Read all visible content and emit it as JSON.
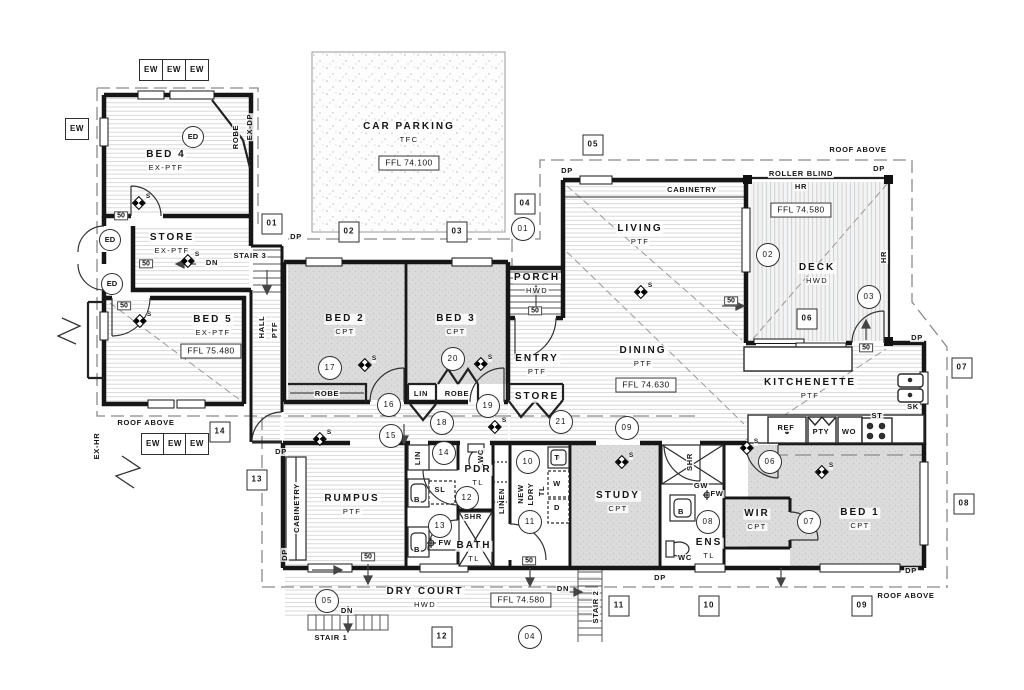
{
  "drawing_title": "Ground Floor Plan",
  "rooms": [
    {
      "nm": "bed-4",
      "l1": "BED 4",
      "l2": "EX-PTF",
      "x": 166,
      "y": 155
    },
    {
      "nm": "store-existing",
      "l1": "STORE",
      "l2": "EX-PTF",
      "x": 172,
      "y": 238
    },
    {
      "nm": "bed-5",
      "l1": "BED 5",
      "l2": "EX-PTF",
      "x": 213,
      "y": 320
    },
    {
      "nm": "car-parking",
      "l1": "CAR PARKING",
      "l2": "TFC",
      "x": 409,
      "y": 127
    },
    {
      "nm": "living",
      "l1": "LIVING",
      "l2": "PTF",
      "x": 640,
      "y": 229
    },
    {
      "nm": "deck",
      "l1": "DECK",
      "l2": "HWD",
      "x": 817,
      "y": 268
    },
    {
      "nm": "bed-2",
      "l1": "BED 2",
      "l2": "CPT",
      "x": 345,
      "y": 319
    },
    {
      "nm": "bed-3",
      "l1": "BED 3",
      "l2": "CPT",
      "x": 456,
      "y": 319
    },
    {
      "nm": "porch",
      "l1": "PORCH",
      "l2": "HWD",
      "x": 537,
      "y": 278
    },
    {
      "nm": "entry",
      "l1": "ENTRY",
      "l2": "PTF",
      "x": 537,
      "y": 359
    },
    {
      "nm": "entry-store",
      "l1": "STORE",
      "l2": "",
      "x": 537,
      "y": 397
    },
    {
      "nm": "dining",
      "l1": "DINING",
      "l2": "PTF",
      "x": 643,
      "y": 351
    },
    {
      "nm": "kitchenette",
      "l1": "KITCHENETTE",
      "l2": "PTF",
      "x": 810,
      "y": 383
    },
    {
      "nm": "rumpus",
      "l1": "RUMPUS",
      "l2": "PTF",
      "x": 352,
      "y": 499
    },
    {
      "nm": "pdr",
      "l1": "PDR",
      "l2": "TL",
      "x": 478,
      "y": 470
    },
    {
      "nm": "bath",
      "l1": "BATH",
      "l2": "TL",
      "x": 474,
      "y": 546
    },
    {
      "nm": "study",
      "l1": "STUDY",
      "l2": "CPT",
      "x": 618,
      "y": 496
    },
    {
      "nm": "wir",
      "l1": "WIR",
      "l2": "CPT",
      "x": 757,
      "y": 514
    },
    {
      "nm": "bed-1",
      "l1": "BED 1",
      "l2": "CPT",
      "x": 860,
      "y": 513
    },
    {
      "nm": "ens",
      "l1": "ENS",
      "l2": "TL",
      "x": 709,
      "y": 543
    },
    {
      "nm": "dry-court",
      "l1": "DRY COURT",
      "l2": "HWD",
      "x": 425,
      "y": 592
    }
  ],
  "ffl": [
    {
      "t": "FFL 74.100",
      "x": 409,
      "y": 163
    },
    {
      "t": "FFL 74.580",
      "x": 801,
      "y": 210
    },
    {
      "t": "FFL 75.480",
      "x": 211,
      "y": 351
    },
    {
      "t": "FFL 74.630",
      "x": 646,
      "y": 385
    },
    {
      "t": "FFL 74.580",
      "x": 521,
      "y": 600
    }
  ],
  "markers": {
    "circles": [
      {
        "n": "01",
        "x": 523,
        "y": 229
      },
      {
        "n": "02",
        "x": 768,
        "y": 255
      },
      {
        "n": "03",
        "x": 869,
        "y": 297
      },
      {
        "n": "04",
        "x": 530,
        "y": 637
      },
      {
        "n": "05",
        "x": 327,
        "y": 601
      },
      {
        "n": "06",
        "x": 770,
        "y": 462
      },
      {
        "n": "07",
        "x": 809,
        "y": 522
      },
      {
        "n": "08",
        "x": 708,
        "y": 522
      },
      {
        "n": "09",
        "x": 627,
        "y": 428
      },
      {
        "n": "10",
        "x": 528,
        "y": 462
      },
      {
        "n": "11",
        "x": 530,
        "y": 522
      },
      {
        "n": "12",
        "x": 467,
        "y": 498
      },
      {
        "n": "13",
        "x": 440,
        "y": 526
      },
      {
        "n": "14",
        "x": 444,
        "y": 453
      },
      {
        "n": "15",
        "x": 391,
        "y": 436
      },
      {
        "n": "16",
        "x": 389,
        "y": 405
      },
      {
        "n": "17",
        "x": 330,
        "y": 368
      },
      {
        "n": "18",
        "x": 442,
        "y": 423
      },
      {
        "n": "19",
        "x": 488,
        "y": 406
      },
      {
        "n": "20",
        "x": 453,
        "y": 359
      },
      {
        "n": "21",
        "x": 561,
        "y": 422
      }
    ],
    "squares": [
      {
        "n": "01",
        "x": 272,
        "y": 224
      },
      {
        "n": "02",
        "x": 349,
        "y": 232
      },
      {
        "n": "03",
        "x": 457,
        "y": 232
      },
      {
        "n": "04",
        "x": 525,
        "y": 204
      },
      {
        "n": "05",
        "x": 593,
        "y": 145
      },
      {
        "n": "06",
        "x": 807,
        "y": 319
      },
      {
        "n": "07",
        "x": 962,
        "y": 368
      },
      {
        "n": "08",
        "x": 964,
        "y": 504
      },
      {
        "n": "09",
        "x": 862,
        "y": 606
      },
      {
        "n": "10",
        "x": 709,
        "y": 606
      },
      {
        "n": "11",
        "x": 619,
        "y": 606
      },
      {
        "n": "12",
        "x": 442,
        "y": 637
      },
      {
        "n": "13",
        "x": 257,
        "y": 480
      },
      {
        "n": "14",
        "x": 220,
        "y": 432
      }
    ]
  },
  "ew": [
    {
      "t": "EW",
      "x": 151,
      "y": 70
    },
    {
      "t": "EW",
      "x": 174,
      "y": 70
    },
    {
      "t": "EW",
      "x": 197,
      "y": 70
    },
    {
      "t": "EW",
      "x": 77,
      "y": 129
    },
    {
      "t": "EW",
      "x": 153,
      "y": 444
    },
    {
      "t": "EW",
      "x": 175,
      "y": 444
    },
    {
      "t": "EW",
      "x": 197,
      "y": 444
    }
  ],
  "ed": [
    {
      "t": "ED",
      "x": 193,
      "y": 137
    },
    {
      "t": "ED",
      "x": 110,
      "y": 240
    },
    {
      "t": "ED",
      "x": 112,
      "y": 284
    }
  ],
  "fifty": [
    {
      "t": "50",
      "x": 121,
      "y": 216
    },
    {
      "t": "50",
      "x": 146,
      "y": 264
    },
    {
      "t": "50",
      "x": 124,
      "y": 306
    },
    {
      "t": "50",
      "x": 535,
      "y": 311
    },
    {
      "t": "50",
      "x": 731,
      "y": 301
    },
    {
      "t": "50",
      "x": 866,
      "y": 348
    },
    {
      "t": "50",
      "x": 368,
      "y": 557
    },
    {
      "t": "50",
      "x": 529,
      "y": 561
    }
  ],
  "notes": [
    {
      "t": "ROOF ABOVE",
      "x": 858,
      "y": 150
    },
    {
      "t": "ROOF ABOVE",
      "x": 146,
      "y": 423
    },
    {
      "t": "ROOF ABOVE",
      "x": 906,
      "y": 596
    },
    {
      "t": "ROLLER BLIND",
      "x": 801,
      "y": 174
    },
    {
      "t": "HR",
      "x": 801,
      "y": 187
    },
    {
      "t": "HR",
      "x": 884,
      "y": 257,
      "rot": 1
    },
    {
      "t": "CABINETRY",
      "x": 692,
      "y": 190
    },
    {
      "t": "CABINETRY",
      "x": 297,
      "y": 508,
      "rot": 1
    },
    {
      "t": "STAIR 3",
      "x": 250,
      "y": 256
    },
    {
      "t": "STAIR 1",
      "x": 331,
      "y": 638
    },
    {
      "t": "STAIR 2",
      "x": 596,
      "y": 607,
      "rot": 1
    },
    {
      "t": "HALL",
      "x": 262,
      "y": 327,
      "rot": 1
    },
    {
      "t": "PTF",
      "x": 275,
      "y": 330,
      "rot": 1
    },
    {
      "t": "ROBE",
      "x": 236,
      "y": 137,
      "rot": 1
    },
    {
      "t": "EX-DP",
      "x": 250,
      "y": 127,
      "rot": 1
    },
    {
      "t": "EX-HR",
      "x": 97,
      "y": 446,
      "rot": 1
    },
    {
      "t": "LIN",
      "x": 418,
      "y": 458,
      "rot": 1
    },
    {
      "t": "LINEN",
      "x": 502,
      "y": 501,
      "rot": 1
    },
    {
      "t": "NEW",
      "x": 521,
      "y": 494,
      "rot": 1
    },
    {
      "t": "LDRY",
      "x": 531,
      "y": 494,
      "rot": 1
    },
    {
      "t": "TL",
      "x": 542,
      "y": 491,
      "rot": 1
    },
    {
      "t": "SHR",
      "x": 690,
      "y": 462,
      "rot": 1
    },
    {
      "t": "WC",
      "x": 481,
      "y": 456,
      "rot": 1
    },
    {
      "t": "ROBE",
      "x": 327,
      "y": 394
    },
    {
      "t": "LIN",
      "x": 421,
      "y": 394
    },
    {
      "t": "ROBE",
      "x": 457,
      "y": 394
    },
    {
      "t": "REF",
      "x": 786,
      "y": 428
    },
    {
      "t": "PTY",
      "x": 821,
      "y": 432
    },
    {
      "t": "WO",
      "x": 849,
      "y": 432
    },
    {
      "t": "ST",
      "x": 877,
      "y": 416
    },
    {
      "t": "SK",
      "x": 913,
      "y": 407
    },
    {
      "t": "T",
      "x": 557,
      "y": 458
    },
    {
      "t": "W",
      "x": 557,
      "y": 484
    },
    {
      "t": "D",
      "x": 557,
      "y": 508
    },
    {
      "t": "B",
      "x": 417,
      "y": 500
    },
    {
      "t": "B",
      "x": 417,
      "y": 550
    },
    {
      "t": "B",
      "x": 681,
      "y": 512
    },
    {
      "t": "SL",
      "x": 440,
      "y": 490
    },
    {
      "t": "SHR",
      "x": 473,
      "y": 517
    },
    {
      "t": "GW",
      "x": 701,
      "y": 486
    },
    {
      "t": "FW",
      "x": 717,
      "y": 494
    },
    {
      "t": "FW",
      "x": 445,
      "y": 543
    },
    {
      "t": "WC",
      "x": 685,
      "y": 558
    },
    {
      "t": "DP",
      "x": 296,
      "y": 237
    },
    {
      "t": "DP",
      "x": 567,
      "y": 171
    },
    {
      "t": "DP",
      "x": 879,
      "y": 169
    },
    {
      "t": "DP",
      "x": 917,
      "y": 338
    },
    {
      "t": "DP",
      "x": 281,
      "y": 452
    },
    {
      "t": "DP",
      "x": 285,
      "y": 555,
      "rot": 1
    },
    {
      "t": "DP",
      "x": 660,
      "y": 578
    },
    {
      "t": "DP",
      "x": 911,
      "y": 571
    },
    {
      "t": "DN",
      "x": 212,
      "y": 263
    },
    {
      "t": "DN",
      "x": 347,
      "y": 611
    },
    {
      "t": "DN",
      "x": 563,
      "y": 589
    }
  ],
  "smoke": [
    {
      "t": "S",
      "x": 142,
      "y": 203
    },
    {
      "t": "S",
      "x": 191,
      "y": 261
    },
    {
      "t": "S",
      "x": 143,
      "y": 321
    },
    {
      "t": "S",
      "x": 368,
      "y": 365
    },
    {
      "t": "S",
      "x": 484,
      "y": 364
    },
    {
      "t": "S",
      "x": 644,
      "y": 292
    },
    {
      "t": "S",
      "x": 498,
      "y": 427
    },
    {
      "t": "S",
      "x": 323,
      "y": 439
    },
    {
      "t": "S",
      "x": 750,
      "y": 448
    },
    {
      "t": "S",
      "x": 625,
      "y": 462
    },
    {
      "t": "S",
      "x": 825,
      "y": 472
    }
  ]
}
